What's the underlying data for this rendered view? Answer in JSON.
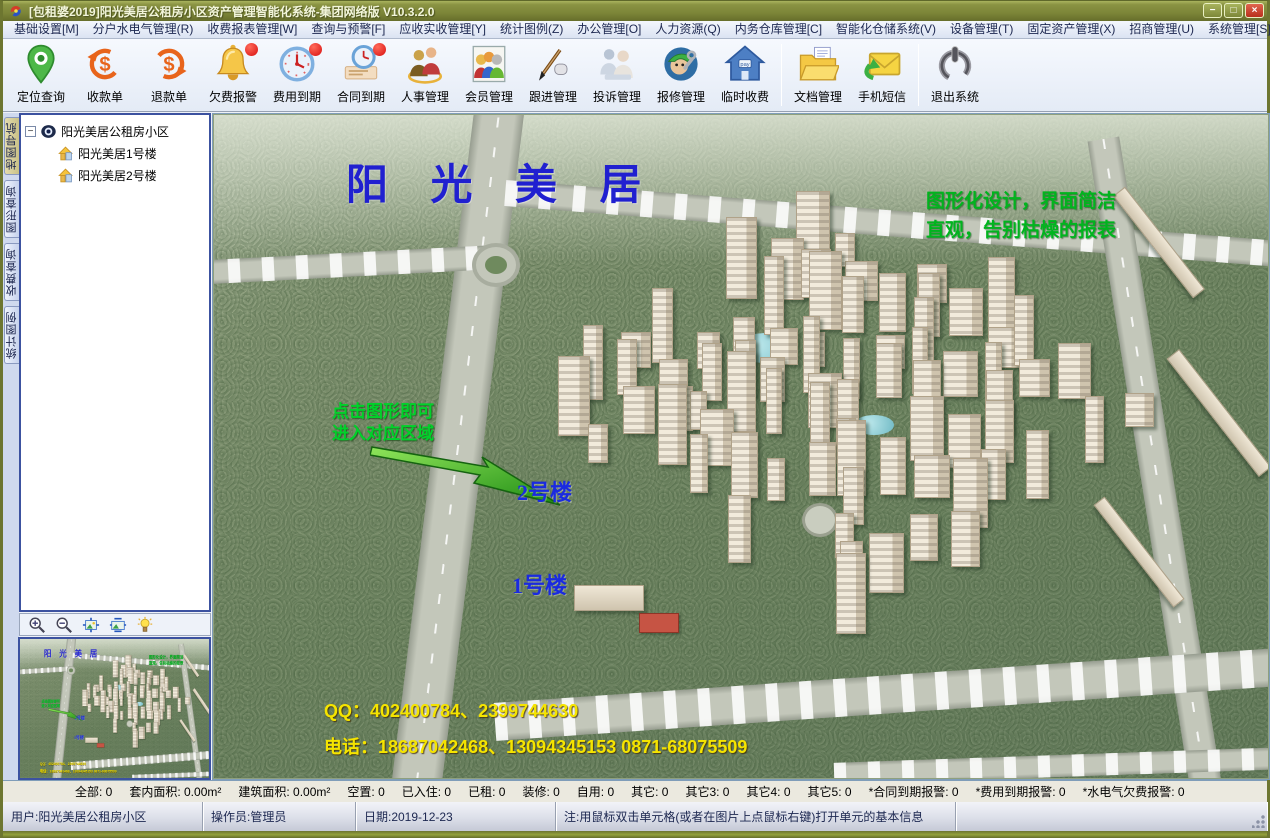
{
  "window": {
    "title": "[包租婆2019]阳光美居公租房小区资产管理智能化系统-集团网络版 V10.3.2.0",
    "buttons": {
      "minimize": "−",
      "maximize": "□",
      "close": "×"
    }
  },
  "colors": {
    "titlebar_olive": "#7c8538",
    "alert_red": "#d80f0f",
    "scene_title_blue": "#2020d0",
    "slogan_green": "#00b41e",
    "contact_yellow": "#f5e400"
  },
  "menu": {
    "items": [
      "基础设置[M]",
      "分户水电气管理(R)",
      "收费报表管理[W]",
      "查询与预警[F]",
      "应收实收管理[Y]",
      "统计图例(Z)",
      "办公管理[O]",
      "人力资源(Q)",
      "内务仓库管理[C]",
      "智能化仓储系统(V)",
      "设备管理(T)",
      "固定资产管理(X)",
      "招商管理(U)",
      "系统管理[S]"
    ]
  },
  "toolbar": {
    "items": [
      {
        "label": "定位查询",
        "icon": "location-pin-icon"
      },
      {
        "label": "收款单",
        "icon": "receipt-in-icon"
      },
      {
        "label": "退款单",
        "icon": "refund-out-icon"
      },
      {
        "label": "欠费报警",
        "icon": "bell-icon",
        "badge": true
      },
      {
        "label": "费用到期",
        "icon": "clock-icon",
        "badge": true
      },
      {
        "label": "合同到期",
        "icon": "contract-clock-icon",
        "badge": true
      },
      {
        "label": "人事管理",
        "icon": "people-two-icon"
      },
      {
        "label": "会员管理",
        "icon": "people-group-icon"
      },
      {
        "label": "跟进管理",
        "icon": "pen-icon"
      },
      {
        "label": "投诉管理",
        "icon": "consult-icon"
      },
      {
        "label": "报修管理",
        "icon": "repairman-icon"
      },
      {
        "label": "临时收费",
        "icon": "house-pay-icon"
      },
      {
        "label": "文档管理",
        "icon": "folder-doc-icon",
        "sep_before": true
      },
      {
        "label": "手机短信",
        "icon": "sms-icon"
      },
      {
        "label": "退出系统",
        "icon": "power-icon",
        "sep_before": true
      }
    ]
  },
  "sidebar": {
    "tabs": [
      {
        "label": "地图导航",
        "active": true
      },
      {
        "label": "图形查询",
        "active": false
      },
      {
        "label": "收费查询",
        "active": false
      },
      {
        "label": "统计图例",
        "active": false
      }
    ],
    "tree": {
      "root": "阳光美居公租房小区",
      "children": [
        "阳光美居1号楼",
        "阳光美居2号楼"
      ]
    },
    "minimap_tools": [
      "zoom-in-icon",
      "zoom-out-icon",
      "fit-image-icon",
      "stretch-image-icon",
      "bulb-icon"
    ]
  },
  "scene": {
    "title": "阳 光 美 居",
    "slogan_line1": "图形化设计，界面简洁",
    "slogan_line2": "直观，告别枯燥的报表",
    "hint_line1": "点击图形即可",
    "hint_line2": "进入对应区域",
    "building2_label": "2号楼",
    "building1_label": "1号楼",
    "qq_line": "QQ：402400784、2399744630",
    "phone_line": "电话：18687042468、13094345153  0871-68075509"
  },
  "stats": {
    "items": [
      {
        "label": "全部",
        "value": "0"
      },
      {
        "label": "套内面积",
        "value": "0.00m²"
      },
      {
        "label": "建筑面积",
        "value": "0.00m²"
      },
      {
        "label": "空置",
        "value": "0"
      },
      {
        "label": "已入住",
        "value": "0"
      },
      {
        "label": "已租",
        "value": "0"
      },
      {
        "label": "装修",
        "value": "0"
      },
      {
        "label": "自用",
        "value": "0"
      },
      {
        "label": "其它",
        "value": "0"
      },
      {
        "label": "其它3",
        "value": "0"
      },
      {
        "label": "其它4",
        "value": "0"
      },
      {
        "label": "其它5",
        "value": "0"
      },
      {
        "label": "*合同到期报警",
        "value": "0"
      },
      {
        "label": "*费用到期报警",
        "value": "0"
      },
      {
        "label": "*水电气欠费报警",
        "value": "0"
      }
    ]
  },
  "statusbar": {
    "user": "用户:阳光美居公租房小区",
    "operator": "操作员:管理员",
    "date": "日期:2019-12-23",
    "note": "注:用鼠标双击单元格(或者在图片上点鼠标右键)打开单元的基本信息"
  }
}
